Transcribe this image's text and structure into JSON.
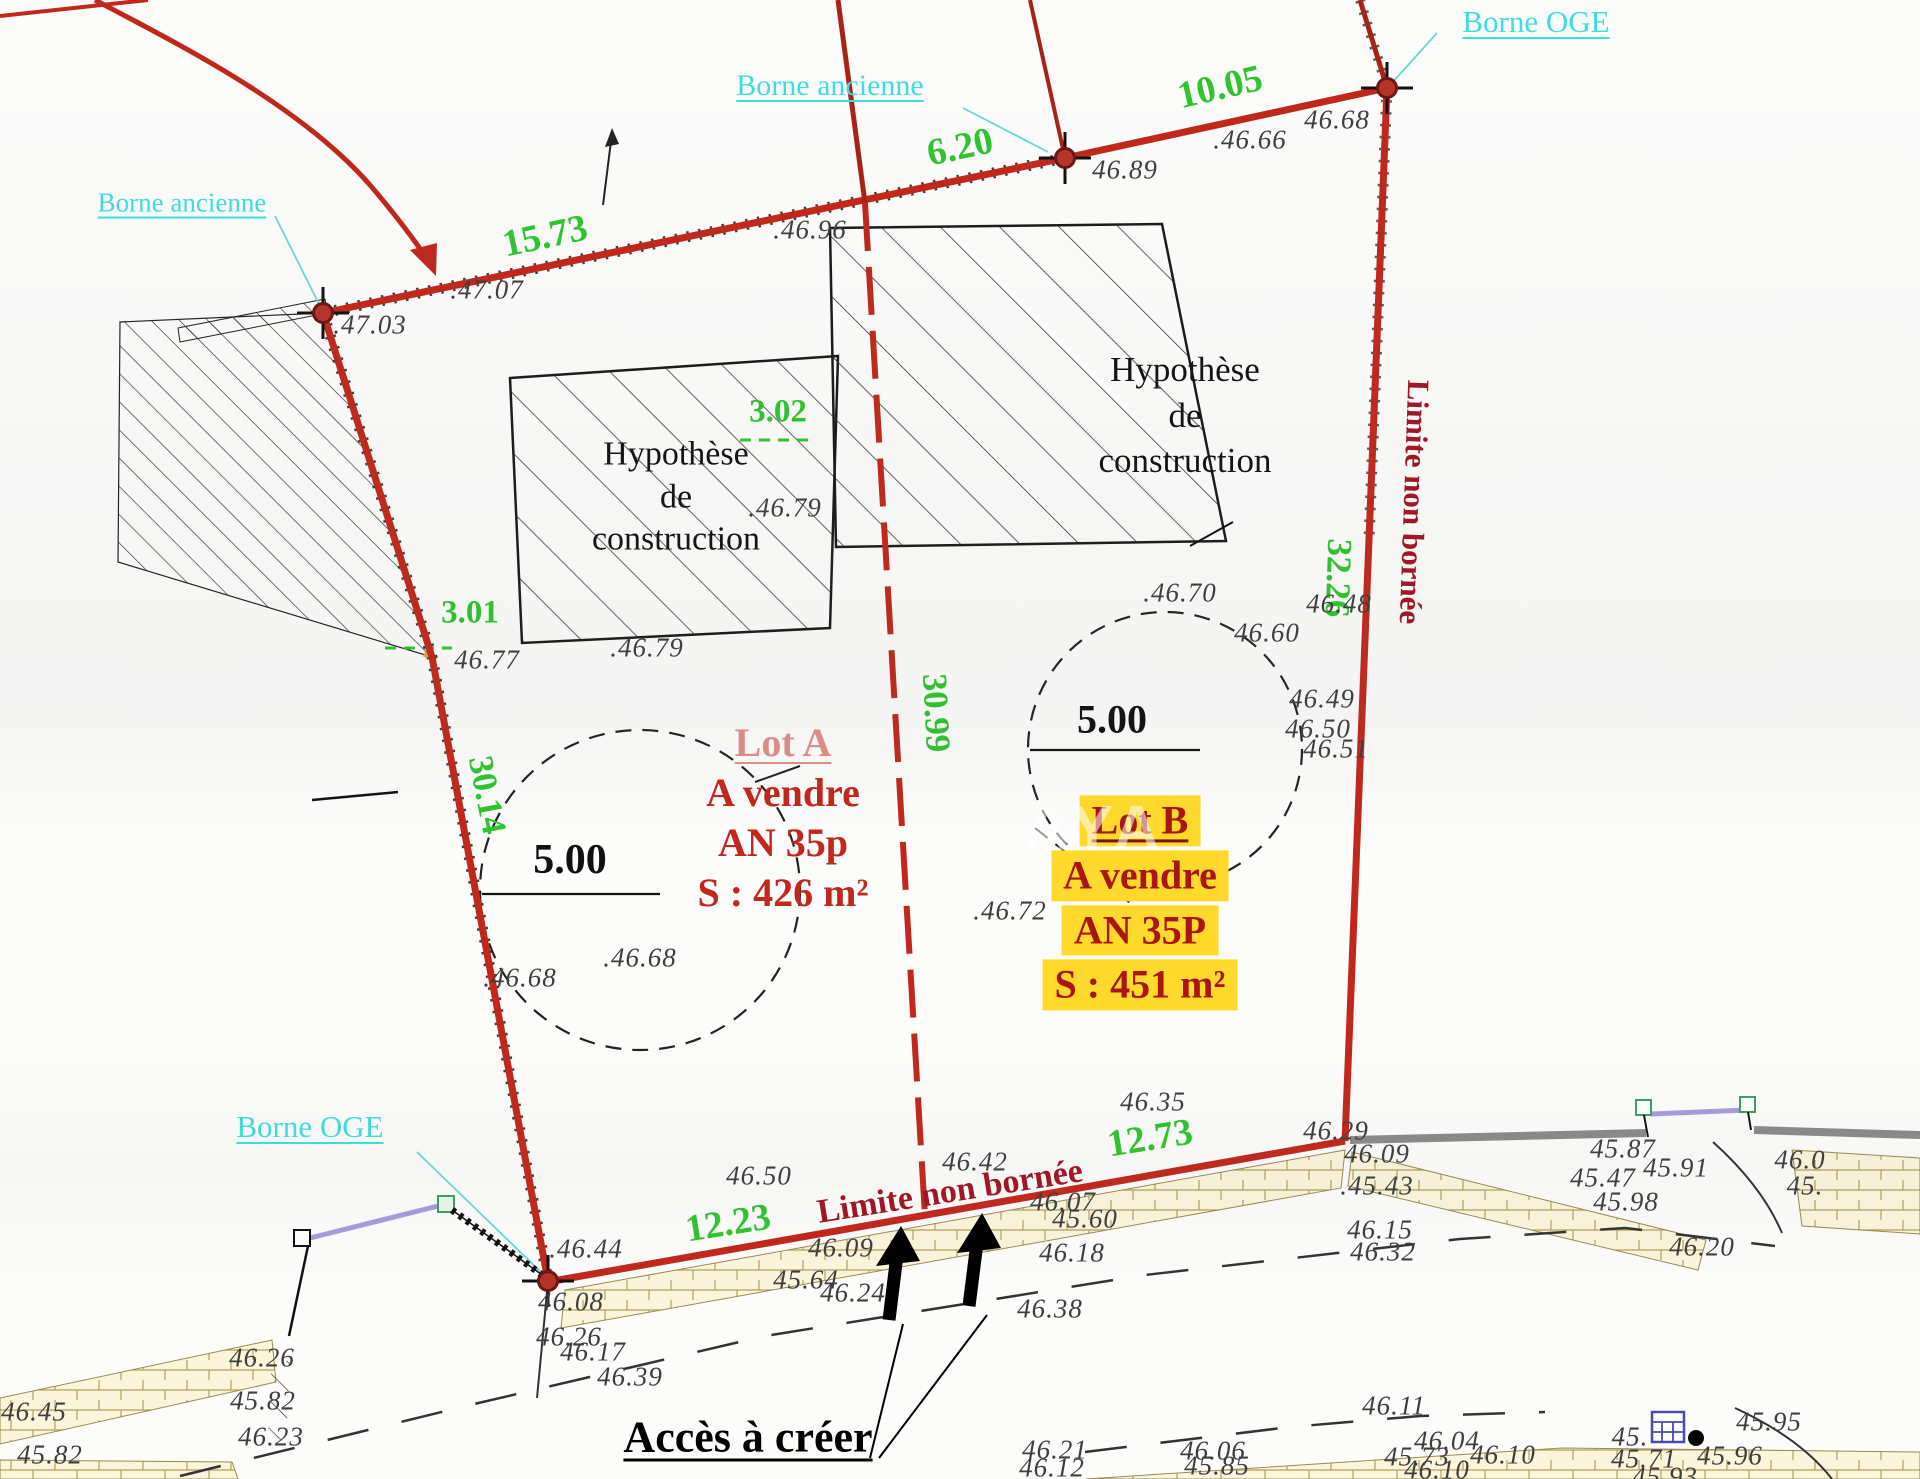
{
  "colors": {
    "boundary_red": "#c1271d",
    "dimension_green": "#2fc42f",
    "borne_cyan": "#3fdede",
    "lot_red": "#c1271d",
    "lot_b_red": "#a81512",
    "highlight_yellow": "#ffd92b",
    "limite_red": "#a21424",
    "wall_sand": "#fbf5dc",
    "wall_gray": "#8a8a8a",
    "gate_purple": "#a89cd8"
  },
  "plan": {
    "marker_labels": [
      {
        "text": "Borne ancienne",
        "x": 182,
        "y": 203,
        "size": 27
      },
      {
        "text": "Borne ancienne",
        "x": 830,
        "y": 86,
        "size": 30
      },
      {
        "text": "Borne OGE",
        "x": 1536,
        "y": 22,
        "size": 31
      },
      {
        "text": "Borne OGE",
        "x": 310,
        "y": 1127,
        "size": 31
      }
    ],
    "dimensions": [
      {
        "text": "15.73",
        "x": 545,
        "y": 236,
        "rot": -12,
        "size": 38
      },
      {
        "text": "6.20",
        "x": 960,
        "y": 147,
        "rot": -12,
        "size": 38
      },
      {
        "text": "10.05",
        "x": 1220,
        "y": 87,
        "rot": -13,
        "size": 38
      },
      {
        "text": "3.01",
        "x": 470,
        "y": 613,
        "rot": 0,
        "size": 33
      },
      {
        "text": "3.02",
        "x": 778,
        "y": 412,
        "rot": 0,
        "size": 33
      },
      {
        "text": "30.14",
        "x": 487,
        "y": 795,
        "rot": 79,
        "size": 35
      },
      {
        "text": "30.99",
        "x": 936,
        "y": 713,
        "rot": 87,
        "size": 35
      },
      {
        "text": "32.26",
        "x": 1338,
        "y": 578,
        "rot": 92,
        "size": 35
      },
      {
        "text": "12.23",
        "x": 728,
        "y": 1223,
        "rot": -9,
        "size": 38
      },
      {
        "text": "12.73",
        "x": 1150,
        "y": 1138,
        "rot": -9,
        "size": 38
      }
    ],
    "radius_labels": [
      {
        "text": "5.00",
        "x": 570,
        "y": 860,
        "size": 42
      },
      {
        "text": "5.00",
        "x": 1112,
        "y": 719,
        "size": 40
      }
    ],
    "elevations": [
      {
        "t": ".47.03",
        "x": 370,
        "y": 325
      },
      {
        "t": ".47.07",
        "x": 487,
        "y": 290
      },
      {
        "t": ".46.96",
        "x": 810,
        "y": 230
      },
      {
        "t": "46.89",
        "x": 1125,
        "y": 170
      },
      {
        "t": ".46.66",
        "x": 1250,
        "y": 140
      },
      {
        "t": "46.68",
        "x": 1337,
        "y": 120
      },
      {
        "t": "46.77",
        "x": 487,
        "y": 660
      },
      {
        "t": ".46.79",
        "x": 647,
        "y": 648
      },
      {
        "t": ".46.79",
        "x": 785,
        "y": 508
      },
      {
        "t": ".46.70",
        "x": 1180,
        "y": 593
      },
      {
        "t": "46.60",
        "x": 1267,
        "y": 633
      },
      {
        "t": "46.48",
        "x": 1339,
        "y": 604
      },
      {
        "t": "46.49",
        "x": 1322,
        "y": 699
      },
      {
        "t": "46.50",
        "x": 1318,
        "y": 729
      },
      {
        "t": "46.51",
        "x": 1336,
        "y": 749
      },
      {
        "t": ".46.72",
        "x": 1010,
        "y": 911
      },
      {
        "t": ".46.68",
        "x": 640,
        "y": 958
      },
      {
        "t": ".46.68",
        "x": 520,
        "y": 978
      },
      {
        "t": "46.35",
        "x": 1153,
        "y": 1102
      },
      {
        "t": "46.29",
        "x": 1336,
        "y": 1131
      },
      {
        "t": "46.09",
        "x": 1377,
        "y": 1154
      },
      {
        "t": "46.50",
        "x": 759,
        "y": 1176
      },
      {
        "t": "46.42",
        "x": 975,
        "y": 1162
      },
      {
        "t": ".46.44",
        "x": 586,
        "y": 1249
      },
      {
        "t": "46.09",
        "x": 841,
        "y": 1248
      },
      {
        "t": "45.64",
        "x": 806,
        "y": 1280
      },
      {
        "t": "46.24",
        "x": 853,
        "y": 1293
      },
      {
        "t": "46.08",
        "x": 571,
        "y": 1302
      },
      {
        "t": "46.26",
        "x": 569,
        "y": 1337
      },
      {
        "t": "46.17",
        "x": 593,
        "y": 1352
      },
      {
        "t": "46.07",
        "x": 1063,
        "y": 1202
      },
      {
        "t": "45.60",
        "x": 1085,
        "y": 1219
      },
      {
        "t": "46.18",
        "x": 1072,
        "y": 1253
      },
      {
        "t": "46.38",
        "x": 1050,
        "y": 1309
      },
      {
        "t": "46.39",
        "x": 630,
        "y": 1377
      },
      {
        "t": ".45.43",
        "x": 1377,
        "y": 1186
      },
      {
        "t": "46.15",
        "x": 1380,
        "y": 1230
      },
      {
        "t": "46.32",
        "x": 1383,
        "y": 1252
      },
      {
        "t": "45.87",
        "x": 1623,
        "y": 1149
      },
      {
        "t": "45.47",
        "x": 1603,
        "y": 1178
      },
      {
        "t": "45.91",
        "x": 1676,
        "y": 1168
      },
      {
        "t": "45.98",
        "x": 1626,
        "y": 1202
      },
      {
        "t": "46.20",
        "x": 1702,
        "y": 1247
      },
      {
        "t": "46.11",
        "x": 1394,
        "y": 1406
      },
      {
        "t": "46.04",
        "x": 1447,
        "y": 1441
      },
      {
        "t": "46.06",
        "x": 1213,
        "y": 1451
      },
      {
        "t": "45.85",
        "x": 1217,
        "y": 1466
      },
      {
        "t": "45.73",
        "x": 1417,
        "y": 1457
      },
      {
        "t": "46.10",
        "x": 1503,
        "y": 1455
      },
      {
        "t": "46.10",
        "x": 1437,
        "y": 1470
      },
      {
        "t": "46.21",
        "x": 1055,
        "y": 1450
      },
      {
        "t": "46.12",
        "x": 1052,
        "y": 1468
      },
      {
        "t": "45.95",
        "x": 1769,
        "y": 1422
      },
      {
        "t": "45.96",
        "x": 1730,
        "y": 1456
      },
      {
        "t": "45.71",
        "x": 1644,
        "y": 1459
      },
      {
        "t": "45.93",
        "x": 1665,
        "y": 1477
      },
      {
        "t": "45.",
        "x": 1630,
        "y": 1437
      },
      {
        "t": "46.0",
        "x": 1800,
        "y": 1160
      },
      {
        "t": "45.",
        "x": 1805,
        "y": 1186
      },
      {
        "t": "46.45",
        "x": 34,
        "y": 1412
      },
      {
        "t": "45.82",
        "x": 263,
        "y": 1401
      },
      {
        "t": "46.26",
        "x": 262,
        "y": 1358
      },
      {
        "t": "45.82",
        "x": 50,
        "y": 1455
      },
      {
        "t": "46.23",
        "x": 271,
        "y": 1437
      }
    ]
  },
  "lot_a": {
    "name": "Lot A",
    "line1": "A vendre",
    "line2": "AN 35p",
    "line3": "S : 426 m²"
  },
  "lot_b": {
    "name": "Lot B",
    "line1": "A vendre",
    "line2": "AN 35P",
    "line3": "S : 451 m²"
  },
  "construction_label": {
    "l1": "Hypothèse",
    "l2": "de",
    "l3": "construction"
  },
  "notes": {
    "limite_bottom": "Limite non bornée",
    "limite_right": "Limite non bornée",
    "acces": "Accès à créer",
    "watermark": "AYA"
  }
}
